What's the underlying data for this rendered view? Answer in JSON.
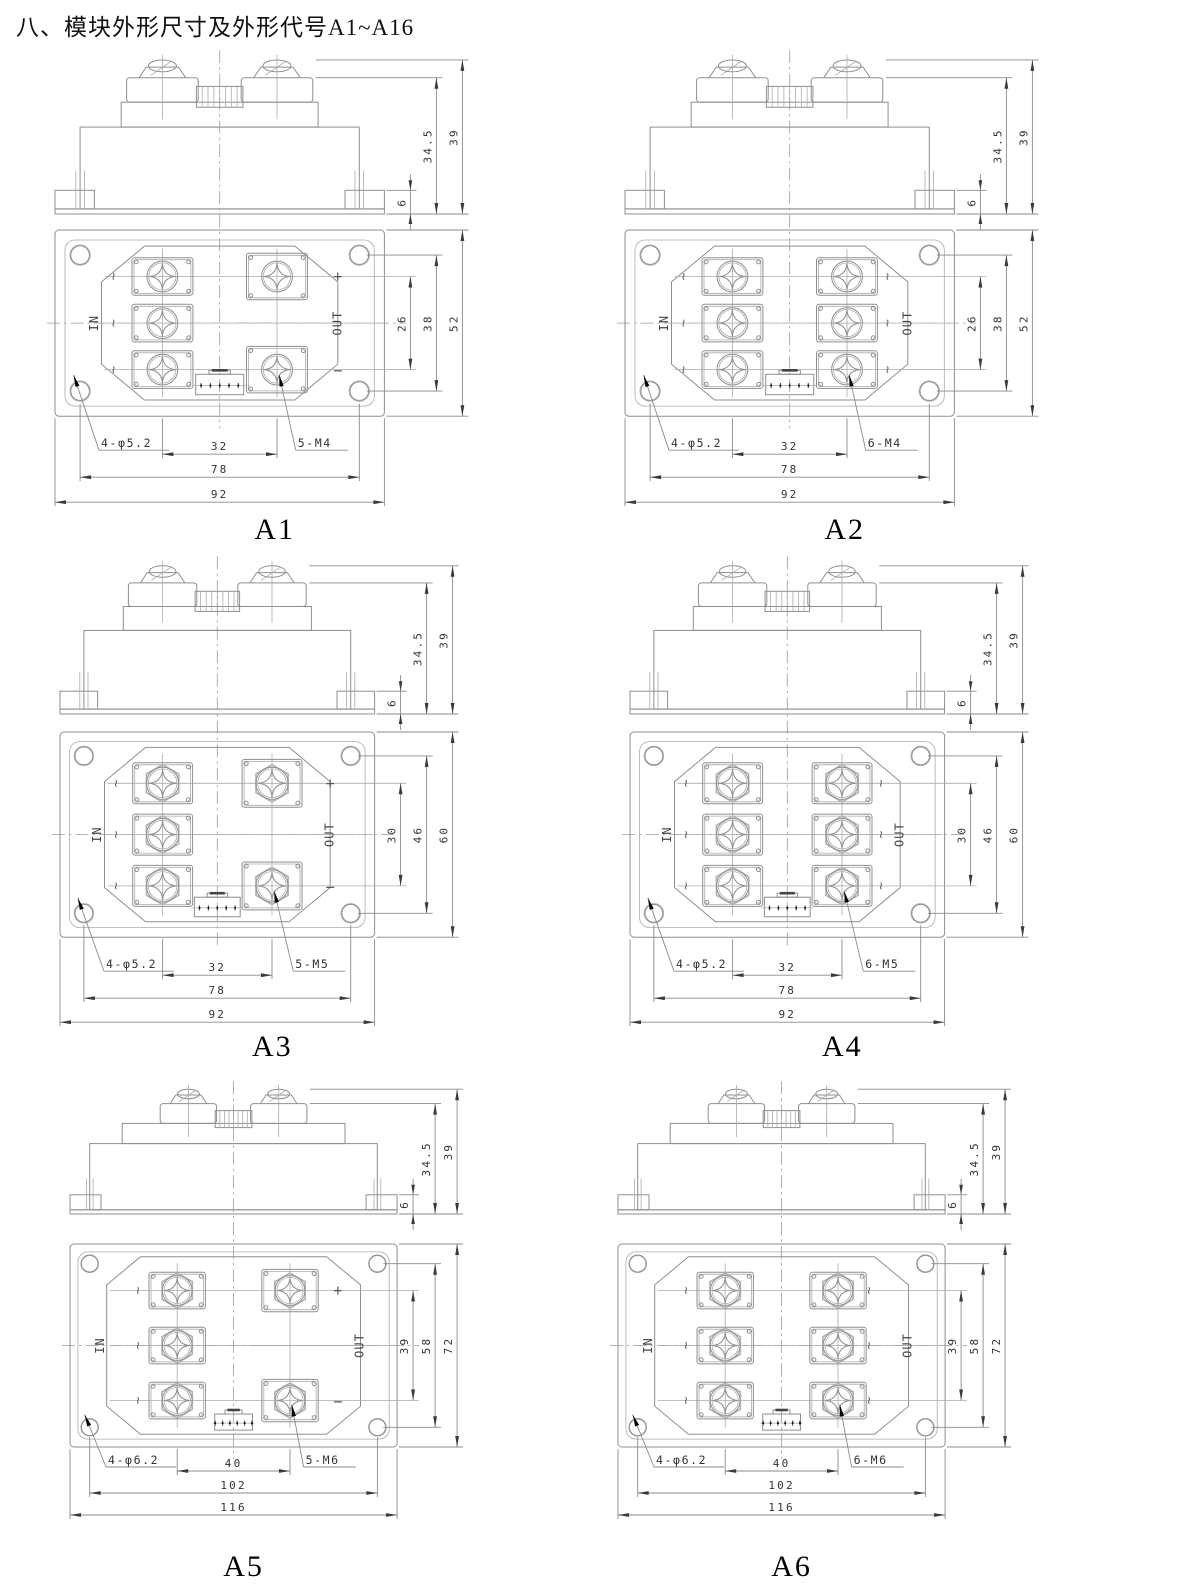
{
  "page": {
    "title": "八、模块外形尺寸及外形代号A1~A16"
  },
  "modules": [
    {
      "id": "a1",
      "label": "A1",
      "terminals": 5,
      "in_label": "IN",
      "out_label": "OUT",
      "ac_mark": "~",
      "plus_mark": "+",
      "minus_mark": "−",
      "holes_label": "4-φ5.2",
      "screws_label": "5-M4",
      "dim_labels": {
        "side": [
          "6",
          "34.5",
          "39"
        ],
        "vertical": [
          "26",
          "38",
          "52"
        ],
        "horizontal": [
          "32",
          "78",
          "92"
        ]
      },
      "mm": {
        "width": 92,
        "height": 52,
        "hole_span_h": 78,
        "hole_span_v": 38,
        "row_span": 26,
        "col_span": 32,
        "hole_d": 5.2,
        "screw_r": 4.3,
        "side_base": 6,
        "side_body": 34.5,
        "side_total": 39
      }
    },
    {
      "id": "a2",
      "label": "A2",
      "terminals": 6,
      "in_label": "IN",
      "out_label": "OUT",
      "ac_mark": "~",
      "plus_mark": "+",
      "minus_mark": "−",
      "holes_label": "4-φ5.2",
      "screws_label": "6-M4",
      "dim_labels": {
        "side": [
          "6",
          "34.5",
          "39"
        ],
        "vertical": [
          "26",
          "38",
          "52"
        ],
        "horizontal": [
          "32",
          "78",
          "92"
        ]
      },
      "mm": {
        "width": 92,
        "height": 52,
        "hole_span_h": 78,
        "hole_span_v": 38,
        "row_span": 26,
        "col_span": 32,
        "hole_d": 5.2,
        "screw_r": 4.3,
        "side_base": 6,
        "side_body": 34.5,
        "side_total": 39
      }
    },
    {
      "id": "a3",
      "label": "A3",
      "terminals": 5,
      "in_label": "IN",
      "out_label": "OUT",
      "ac_mark": "~",
      "plus_mark": "+",
      "minus_mark": "−",
      "holes_label": "4-φ5.2",
      "screws_label": "5-M5",
      "dim_labels": {
        "side": [
          "6",
          "34.5",
          "39"
        ],
        "vertical": [
          "30",
          "46",
          "60"
        ],
        "horizontal": [
          "32",
          "78",
          "92"
        ]
      },
      "mm": {
        "width": 92,
        "height": 60,
        "hole_span_h": 78,
        "hole_span_v": 46,
        "row_span": 30,
        "col_span": 32,
        "hole_d": 5.2,
        "screw_r": 4.7,
        "side_base": 6,
        "side_body": 34.5,
        "side_total": 39
      }
    },
    {
      "id": "a4",
      "label": "A4",
      "terminals": 6,
      "in_label": "IN",
      "out_label": "OUT",
      "ac_mark": "~",
      "plus_mark": "+",
      "minus_mark": "−",
      "holes_label": "4-φ5.2",
      "screws_label": "6-M5",
      "dim_labels": {
        "side": [
          "6",
          "34.5",
          "39"
        ],
        "vertical": [
          "30",
          "46",
          "60"
        ],
        "horizontal": [
          "32",
          "78",
          "92"
        ]
      },
      "mm": {
        "width": 92,
        "height": 60,
        "hole_span_h": 78,
        "hole_span_v": 46,
        "row_span": 30,
        "col_span": 32,
        "hole_d": 5.2,
        "screw_r": 4.7,
        "side_base": 6,
        "side_body": 34.5,
        "side_total": 39
      }
    },
    {
      "id": "a5",
      "label": "A5",
      "terminals": 5,
      "in_label": "IN",
      "out_label": "OUT",
      "ac_mark": "~",
      "plus_mark": "+",
      "minus_mark": "−",
      "holes_label": "4-φ6.2",
      "screws_label": "5-M6",
      "dim_labels": {
        "side": [
          "6",
          "34.5",
          "39"
        ],
        "vertical": [
          "39",
          "58",
          "72"
        ],
        "horizontal": [
          "40",
          "102",
          "116"
        ]
      },
      "mm": {
        "width": 116,
        "height": 72,
        "hole_span_h": 102,
        "hole_span_v": 58,
        "row_span": 39,
        "col_span": 40,
        "hole_d": 6.2,
        "screw_r": 5.3,
        "side_base": 6,
        "side_body": 34.5,
        "side_total": 39
      }
    },
    {
      "id": "a6",
      "label": "A6",
      "terminals": 6,
      "in_label": "IN",
      "out_label": "OUT",
      "ac_mark": "~",
      "plus_mark": "+",
      "minus_mark": "−",
      "holes_label": "4-φ6.2",
      "screws_label": "6-M6",
      "dim_labels": {
        "side": [
          "6",
          "34.5",
          "39"
        ],
        "vertical": [
          "39",
          "58",
          "72"
        ],
        "horizontal": [
          "40",
          "102",
          "116"
        ]
      },
      "mm": {
        "width": 116,
        "height": 72,
        "hole_span_h": 102,
        "hole_span_v": 58,
        "row_span": 39,
        "col_span": 40,
        "hole_d": 6.2,
        "screw_r": 5.3,
        "side_base": 6,
        "side_body": 34.5,
        "side_total": 39
      }
    }
  ]
}
